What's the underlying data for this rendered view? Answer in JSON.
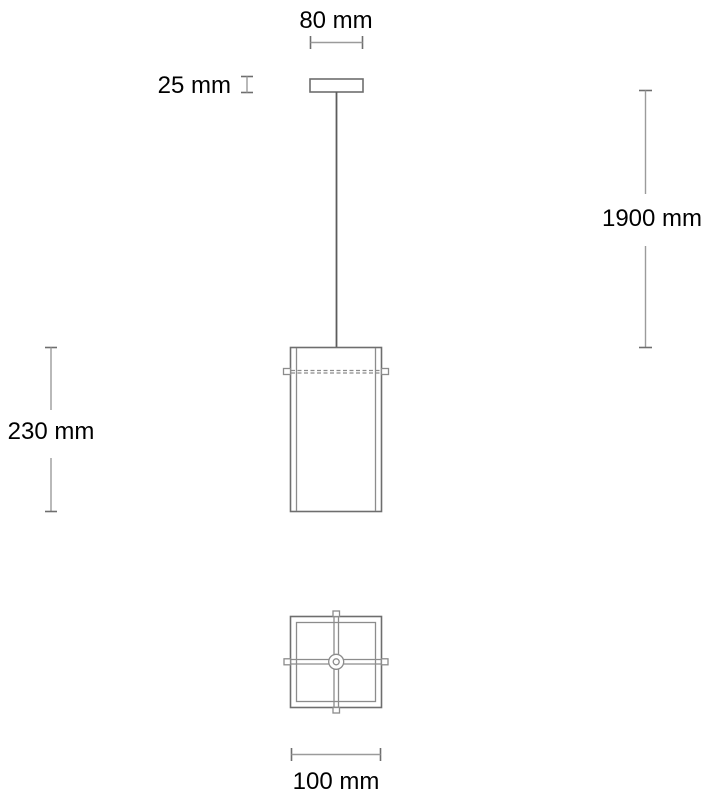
{
  "drawing": {
    "dimensions": {
      "canopy_width": "80 mm",
      "canopy_height": "25 mm",
      "cord_length": "1900 mm",
      "shade_height": "230 mm",
      "shade_width": "100 mm"
    },
    "colors": {
      "outline": "#6e6e6e",
      "thin_line": "#8c8c8c",
      "dimension_line": "#9b9b9b",
      "tick": "#6e6e6e",
      "cord": "#5c5c5c",
      "text": "#000000",
      "background": "#ffffff"
    }
  }
}
